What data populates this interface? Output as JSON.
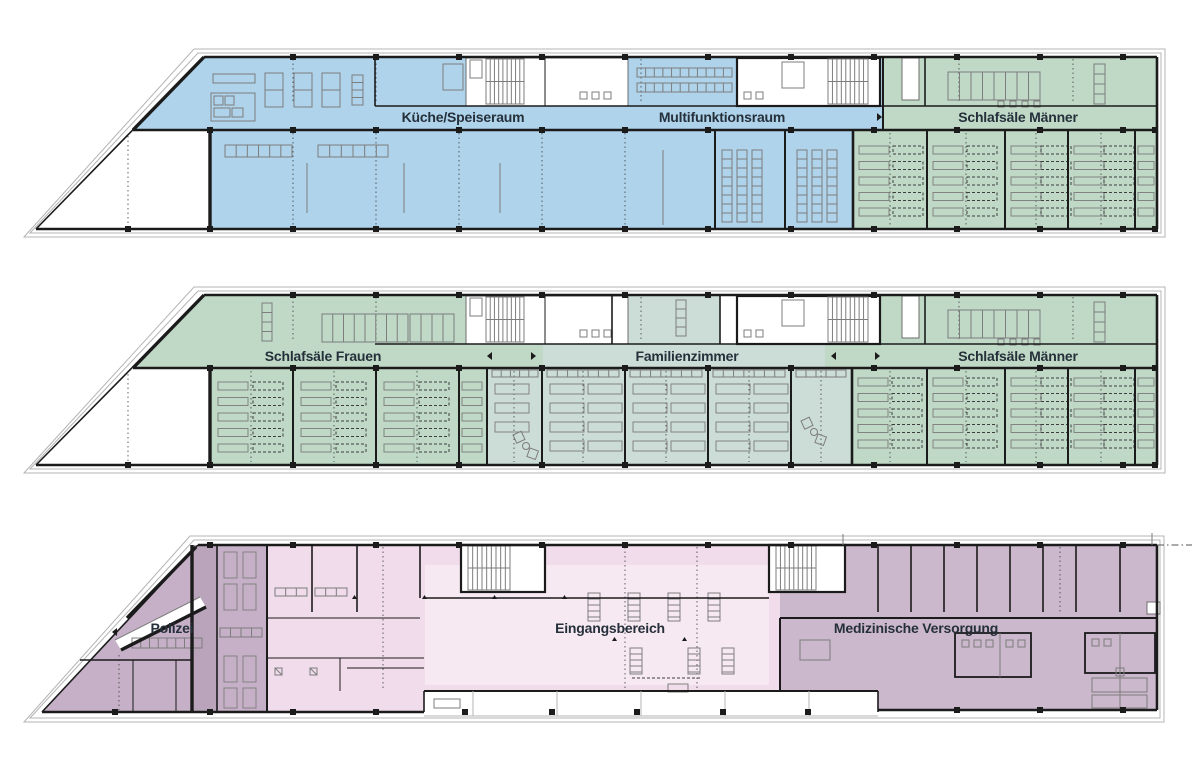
{
  "colors": {
    "blue": "#aed3ea",
    "green": "#bfd9c6",
    "teal": "#ccddd8",
    "pink": "#f0dcea",
    "pink_light": "#f7e9f2",
    "mauve": "#cbb8cc",
    "mauve_dark": "#c6b0c7",
    "mauve_corridor": "#b9a4bb",
    "wall": "#1b1b1b",
    "label_text": "#26303b"
  },
  "floors": [
    {
      "id": "floor-top",
      "rooms": [
        {
          "label": "Küche/Speiseraum"
        },
        {
          "label": "Multifunktionsraum"
        },
        {
          "label": "Schlafsäle Männer"
        }
      ]
    },
    {
      "id": "floor-middle",
      "rooms": [
        {
          "label": "Schlafsäle Frauen"
        },
        {
          "label": "Familienzimmer"
        },
        {
          "label": "Schlafsäle Männer"
        }
      ]
    },
    {
      "id": "floor-ground",
      "rooms": [
        {
          "label": "Polizei"
        },
        {
          "label": "Eingangsbereich"
        },
        {
          "label": "Medizinische Versorgung"
        }
      ]
    }
  ]
}
